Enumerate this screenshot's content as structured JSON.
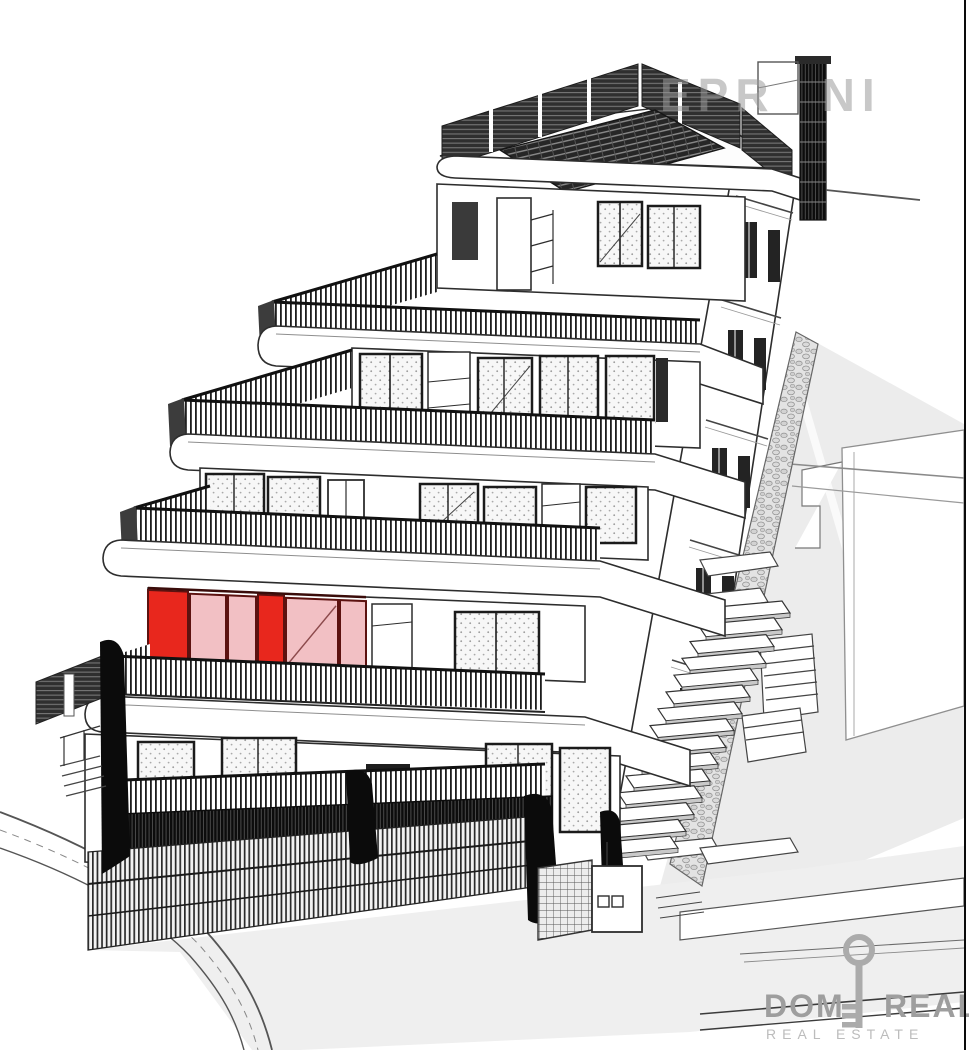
{
  "watermark": {
    "part1": "EPR",
    "part2": "NI"
  },
  "logo": {
    "word1": "DOM",
    "word2": "REAL",
    "subtitle": "REAL ESTATE",
    "icon": "key-icon"
  },
  "highlight": {
    "meaning": "highlighted-apartment-unit",
    "red": "#e8271d",
    "pink": "#f2c0c4",
    "frame": "#5c1210"
  },
  "colors": {
    "line": "#2d2d2d",
    "dark_fill": "#161616",
    "terrain_gray": "#ececec",
    "street_gray": "#efefef",
    "glass_stipple_bg": "#f7f7f7",
    "logo_gray": "#9e9e9e",
    "logo_light_gray": "#bcbcbc",
    "watermark_gray": "#9b9b9b",
    "border_black": "#0a0a0a"
  }
}
